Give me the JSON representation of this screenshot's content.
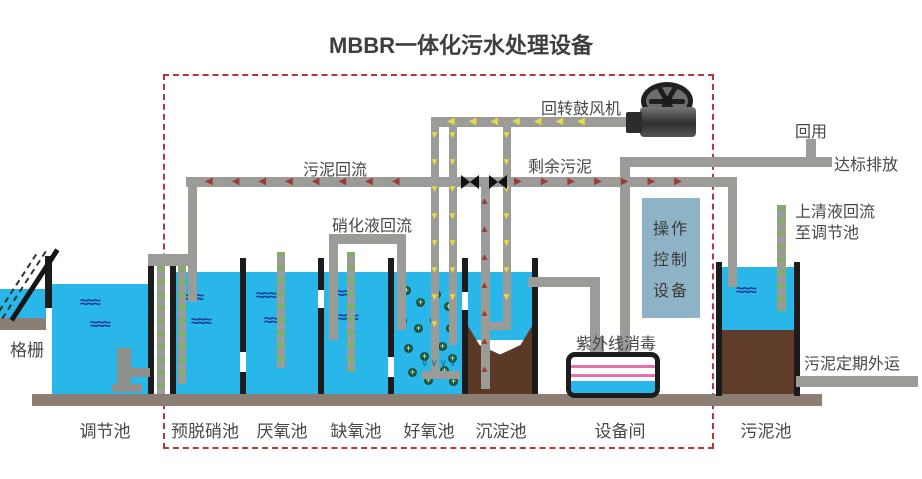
{
  "title": "MBBR一体化污水处理设备",
  "labels": {
    "grid": "格栅",
    "regulating_tank": "调节池",
    "pre_denitrification_tank": "预脱硝池",
    "anaerobic_tank": "厌氧池",
    "anoxic_tank": "缺氧池",
    "aerobic_tank": "好氧池",
    "sedimentation_tank": "沉淀池",
    "equipment_room": "设备间",
    "sludge_tank": "污泥池"
  },
  "flows": {
    "blower": "回转鼓风机",
    "sludge_return": "污泥回流",
    "nitrified_return": "硝化液回流",
    "excess_sludge": "剩余污泥",
    "reuse": "回用",
    "discharge": "达标排放",
    "supernatant_return_l1": "上清液回流",
    "supernatant_return_l2": "至调节池",
    "uv_disinfection": "紫外线消毒",
    "sludge_removal": "污泥定期外运",
    "control_l1": "操作",
    "control_l2": "控制",
    "control_l3": "设备"
  },
  "decorations": {
    "wave": "≈≈≈",
    "air_arrows_left": "◀◀◀◀◀◀◀",
    "air_arrows_down_8": "▼▼▼▼▼▼▼▼",
    "air_arrows_down_7": "▼▼▼▼▼▼▼",
    "sludge_arrows_left": "◀◀◀◀◀◀◀◀",
    "sludge_arrows_right": "▶▶▶▶▶▶▶",
    "lift_arrows_up": "▲▲▲▲▲▲▲",
    "diffuser": "∨∨∨∨"
  },
  "colors": {
    "water": "#29b7e9",
    "wave": "#1c3c97",
    "pipe": "#9b9b98",
    "air-arrow": "#e7d947",
    "sludge-arrow": "#9e3b38",
    "boundary": "#b5373e",
    "sludge": "#5a3a26",
    "ground": "#8b7e75",
    "control-box": "#8fb3c6",
    "uv-pink": "#e273aa"
  }
}
